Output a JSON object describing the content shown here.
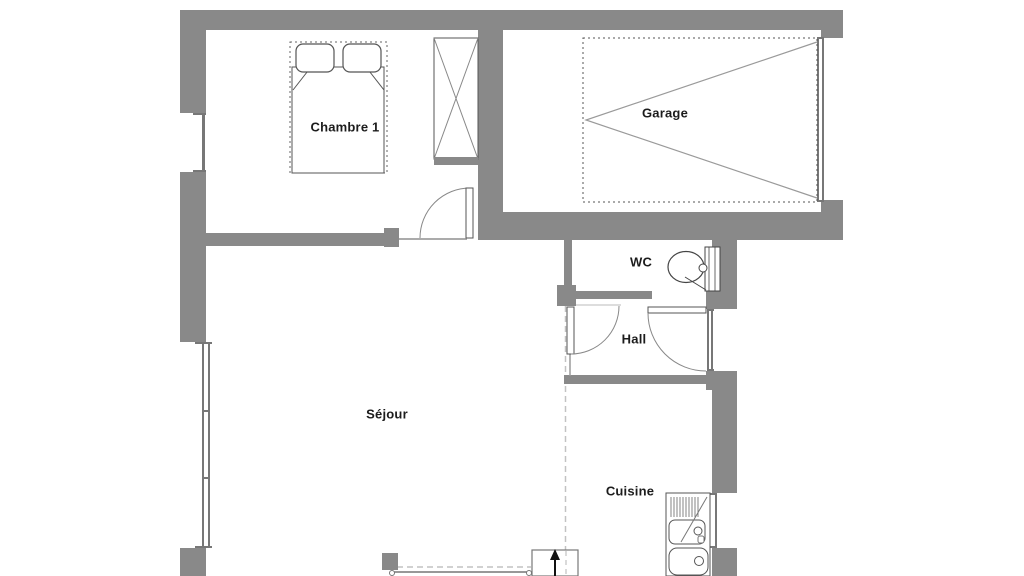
{
  "plan": {
    "type": "floor-plan",
    "rooms": [
      {
        "id": "chambre1",
        "label": "Chambre 1"
      },
      {
        "id": "garage",
        "label": "Garage"
      },
      {
        "id": "wc",
        "label": "WC"
      },
      {
        "id": "hall",
        "label": "Hall"
      },
      {
        "id": "sejour",
        "label": "Séjour"
      },
      {
        "id": "cuisine",
        "label": "Cuisine"
      }
    ],
    "fixtures": [
      "double-bed",
      "wardrobe",
      "toilet",
      "kitchen-sink",
      "garage-door",
      "entrance-arrow"
    ],
    "colors": {
      "wall": "#898989",
      "furniture_line": "#555555",
      "light_line": "#9a9a9a",
      "dashed_line": "#c2c2c2",
      "text": "#1c1c1c",
      "background": "#ffffff"
    }
  }
}
